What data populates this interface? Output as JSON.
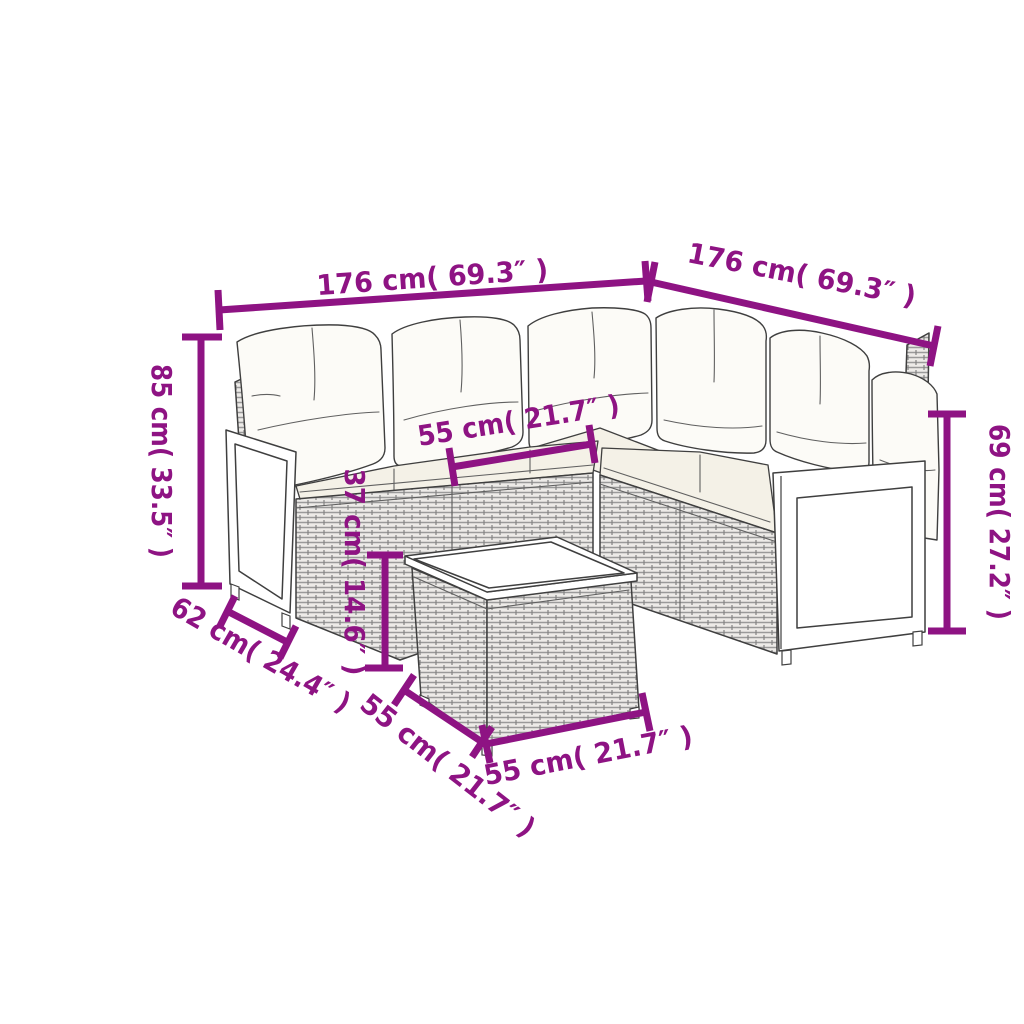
{
  "figure": {
    "alt": "Dimension diagram of a poly rattan corner sofa set with wood-slat arm panels, cushions and a square coffee table",
    "background": "#ffffff",
    "accent_color": "#8e1383",
    "line_color": "#3f3f3f"
  },
  "dimensions": {
    "sofa_left_length": {
      "label": "176 cm( 69.3″ )"
    },
    "sofa_right_length": {
      "label": "176 cm( 69.3″ )"
    },
    "sofa_height": {
      "label": "85 cm( 33.5″ )"
    },
    "backrest_height": {
      "label": "69 cm( 27.2″ )"
    },
    "seat_width": {
      "label": "55 cm( 21.7″ )"
    },
    "table_height": {
      "label": "37 cm( 14.6″ )"
    },
    "seat_depth": {
      "label": "62 cm( 24.4″ )"
    },
    "table_side_depth": {
      "label": "55 cm( 21.7″ )"
    },
    "table_side_width": {
      "label": "55 cm( 21.7″ )"
    }
  }
}
